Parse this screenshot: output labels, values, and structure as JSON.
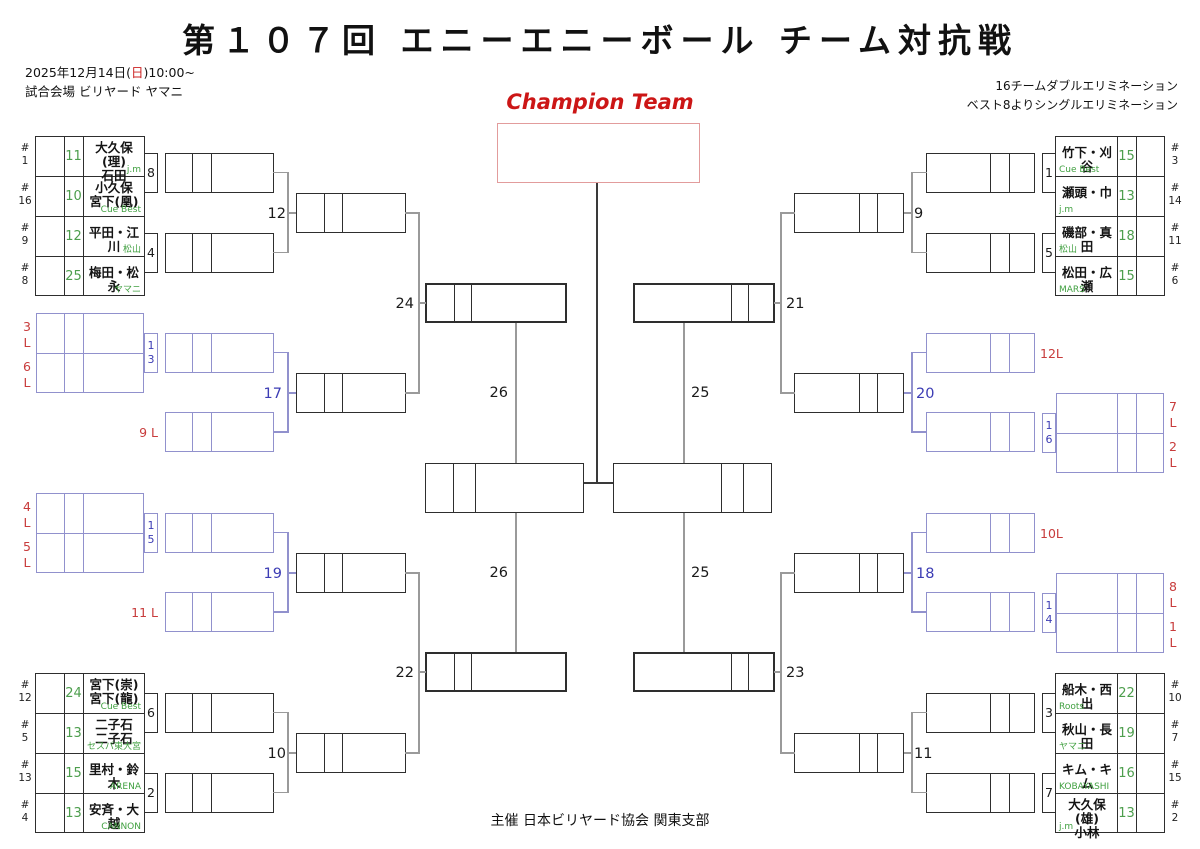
{
  "title": "第１０７回 エニーエニーボール チーム対抗戦",
  "header": {
    "date_prefix": "2025年12月14日(",
    "date_day": "日",
    "date_suffix": ")10:00~",
    "venue": "試合会場 ビリヤード ヤマニ",
    "format_line1": "16チームダブルエリミネーション",
    "format_line2": "ベスト8よりシングルエリミネーション"
  },
  "champion_label": "Champion Team",
  "footer": "主催 日本ビリヤード協会 関東支部",
  "seed_prefix": "#",
  "loser_suffix": "L",
  "colors": {
    "green": "#4d9e4d",
    "blue_line": "#9191cd",
    "blue_text": "#3c3cb4",
    "red_label": "#c83c3c",
    "champion_red": "#cc1616"
  },
  "matches": {
    "wtl": {
      "m1": "8",
      "m2": "4",
      "r2": "12"
    },
    "wbl": {
      "m1": "6",
      "m2": "2",
      "r2": "10"
    },
    "wtr": {
      "m1": "1",
      "m2": "5",
      "r2": "9"
    },
    "wbr": {
      "m1": "3",
      "m2": "7",
      "r2": "11"
    },
    "qf": {
      "tl": "24",
      "tr": "21",
      "bl": "22",
      "br": "23"
    },
    "sf": {
      "left": "26",
      "right": "25"
    },
    "losers": {
      "tl": {
        "drop1": "3",
        "drop2": "6",
        "conn1": "1",
        "conn2": "3",
        "drop3": "9 L",
        "r2": "17"
      },
      "bl": {
        "drop1": "4",
        "drop2": "5",
        "conn1": "1",
        "conn2": "5",
        "drop3": "11 L",
        "r2": "19"
      },
      "tr": {
        "drop1": "7",
        "drop2": "2",
        "conn1": "1",
        "conn2": "6",
        "drop3": "12L",
        "r2": "20"
      },
      "br": {
        "drop1": "8",
        "drop2": "1",
        "conn1": "1",
        "conn2": "4",
        "drop3": "10L",
        "r2": "18"
      }
    }
  },
  "teams": {
    "wtl": [
      {
        "seed": "1",
        "score": "11",
        "name1": "大久保(理)",
        "name2": "石田",
        "club": "j.m"
      },
      {
        "seed": "16",
        "score": "10",
        "name1": "小久保",
        "name2": "宮下(凰)",
        "club": "Cue Best"
      },
      {
        "seed": "9",
        "score": "12",
        "name1": "平田・江川",
        "name2": "",
        "club": "松山"
      },
      {
        "seed": "8",
        "score": "25",
        "name1": "梅田・松永",
        "name2": "",
        "club": "ヤマニ"
      }
    ],
    "wbl": [
      {
        "seed": "12",
        "score": "24",
        "name1": "宮下(崇)",
        "name2": "宮下(龍)",
        "club": "Cue Best"
      },
      {
        "seed": "5",
        "score": "13",
        "name1": "二子石",
        "name2": "二子石",
        "club": "セスパ東大宮"
      },
      {
        "seed": "13",
        "score": "15",
        "name1": "里村・鈴木",
        "name2": "",
        "club": "ARENA"
      },
      {
        "seed": "4",
        "score": "13",
        "name1": "安斉・大越",
        "name2": "",
        "club": "CANNON"
      }
    ],
    "wtr": [
      {
        "seed": "3",
        "score": "15",
        "name1": "竹下・刈谷",
        "name2": "",
        "club": "Cue Best"
      },
      {
        "seed": "14",
        "score": "13",
        "name1": "瀬頭・巾",
        "name2": "",
        "club": "j.m"
      },
      {
        "seed": "11",
        "score": "18",
        "name1": "磯部・真田",
        "name2": "",
        "club": "松山"
      },
      {
        "seed": "6",
        "score": "15",
        "name1": "松田・広瀬",
        "name2": "",
        "club": "MARS"
      }
    ],
    "wbr": [
      {
        "seed": "10",
        "score": "22",
        "name1": "船木・西出",
        "name2": "",
        "club": "Roots"
      },
      {
        "seed": "7",
        "score": "19",
        "name1": "秋山・長田",
        "name2": "",
        "club": "ヤマニ"
      },
      {
        "seed": "15",
        "score": "16",
        "name1": "キム・キム",
        "name2": "",
        "club": "KOBAYASHI"
      },
      {
        "seed": "2",
        "score": "13",
        "name1": "大久保(雄)",
        "name2": "小林",
        "club": "j.m"
      }
    ]
  }
}
